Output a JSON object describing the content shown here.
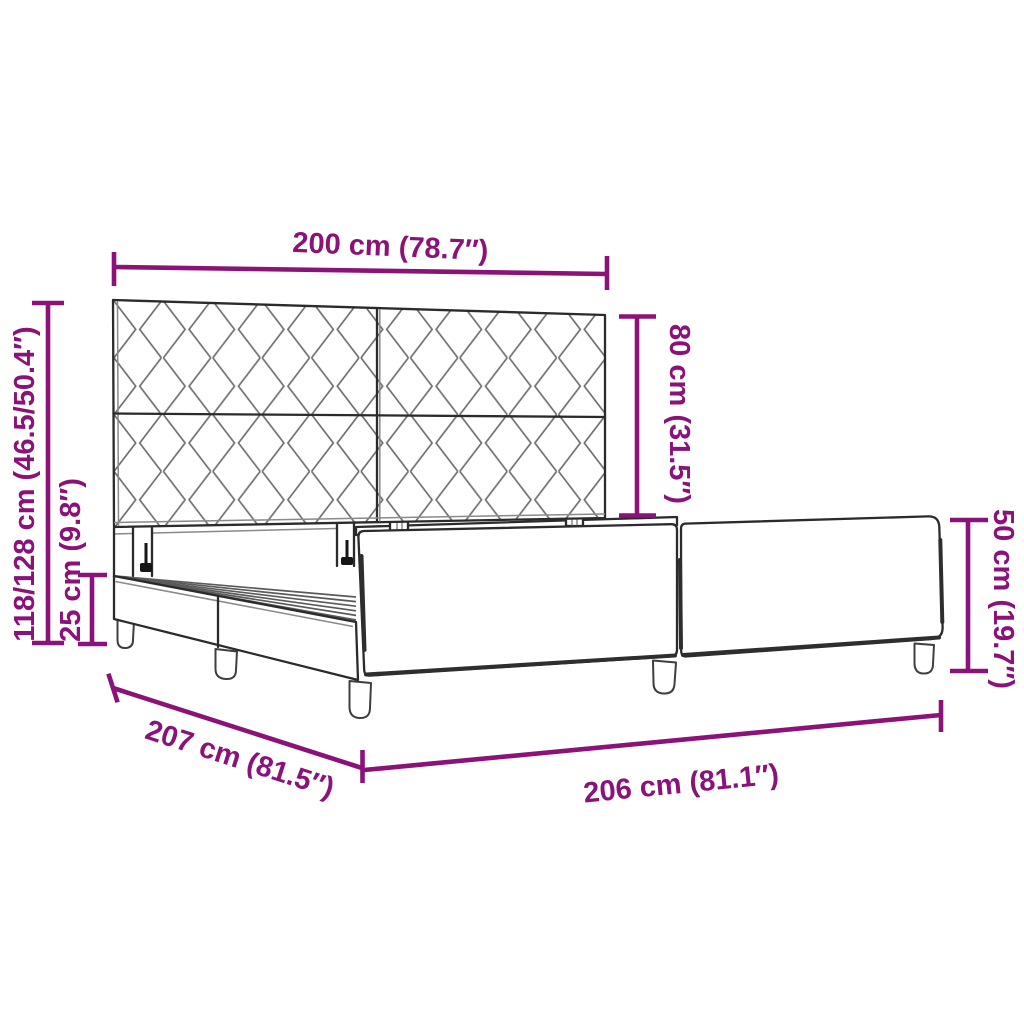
{
  "figure": {
    "title": "Bed frame with headboard — dimension diagram",
    "style": "technical line drawing with dimension callouts"
  },
  "colors": {
    "dimension": "#8A1278",
    "outline": "#2b2b2b",
    "background": "#ffffff"
  },
  "dimensions": {
    "headboard_width": "200 cm (78.7″)",
    "headboard_height": "80 cm (31.5″)",
    "total_height": "118/128 cm (46.5/50.4″)",
    "base_height": "25 cm (9.8″)",
    "side_rail_height": "50 cm (19.7″)",
    "frame_length": "206 cm (81.1″)",
    "frame_width": "207 cm (81.5″)"
  }
}
